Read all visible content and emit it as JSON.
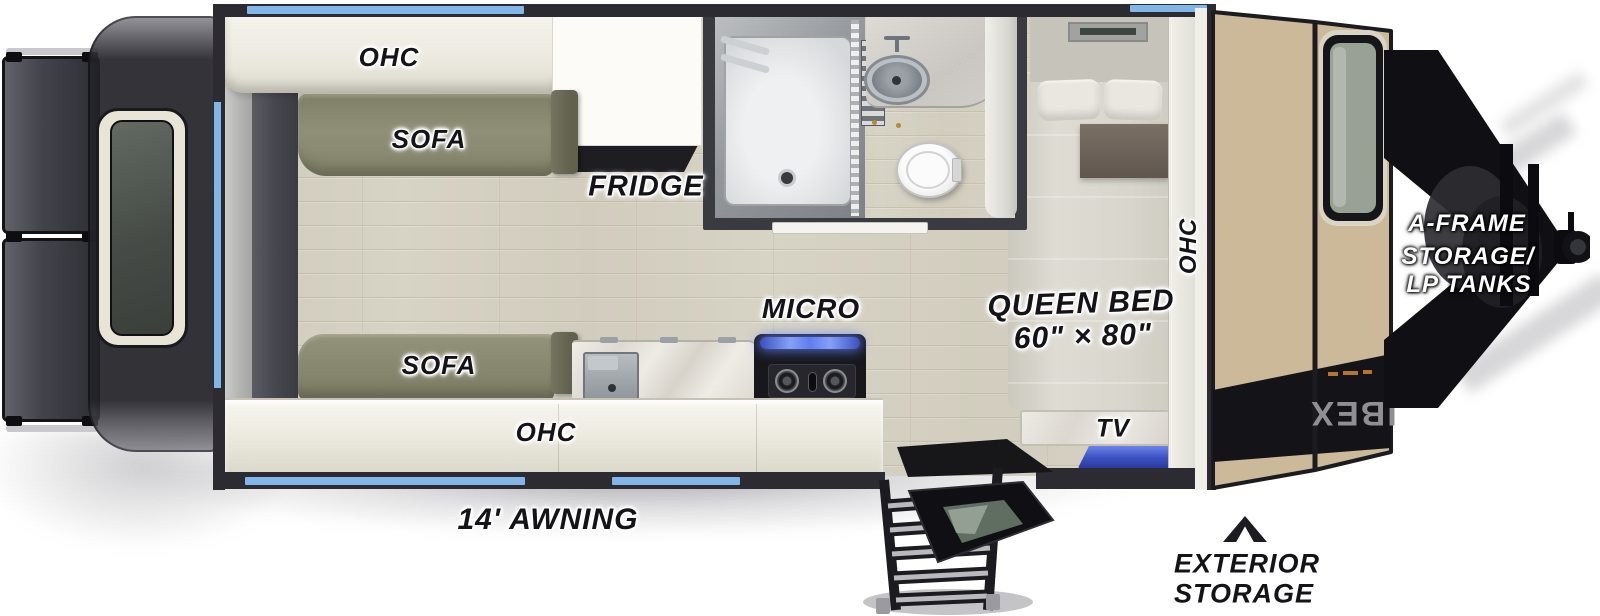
{
  "diagram": {
    "type": "travel-trailer-floorplan",
    "labels": {
      "ohc_top": "OHC",
      "sofa_top": "SOFA",
      "fridge": "FRIDGE",
      "micro": "MICRO",
      "sofa_bottom": "SOFA",
      "ohc_bottom": "OHC",
      "ohc_front": "OHC",
      "queen_bed": "QUEEN BED",
      "queen_bed_size": "60\" × 80\"",
      "tv": "TV",
      "awning": "14' AWNING",
      "exterior_storage": {
        "line1": "EXTERIOR",
        "line2": "STORAGE"
      },
      "a_frame": {
        "line1": "A-FRAME",
        "line2": "STORAGE/",
        "line3": "LP TANKS"
      },
      "brand_logo": "IBEX"
    },
    "colors": {
      "wall": "#2b2b31",
      "window_accent": "#82b6e8",
      "floor_wood": "#d7d3c5",
      "sofa": "#8d8c74",
      "cabinet_cream": "#edebe0",
      "front_cap_tan": "#cbb999",
      "tv_blue": "#4557c8",
      "label_text": "#141418"
    }
  }
}
